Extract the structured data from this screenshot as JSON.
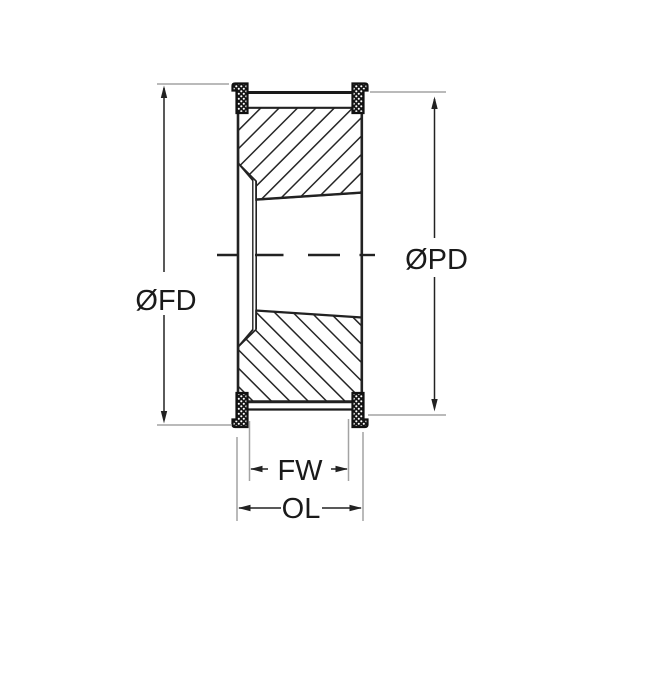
{
  "drawing": {
    "labels": {
      "flange_diameter": "ØFD",
      "pitch_diameter": "ØPD",
      "face_width": "FW",
      "overall_length": "OL"
    },
    "colors": {
      "line": "#222222",
      "extension_line": "#a3a3a3",
      "background": "#ffffff"
    }
  }
}
